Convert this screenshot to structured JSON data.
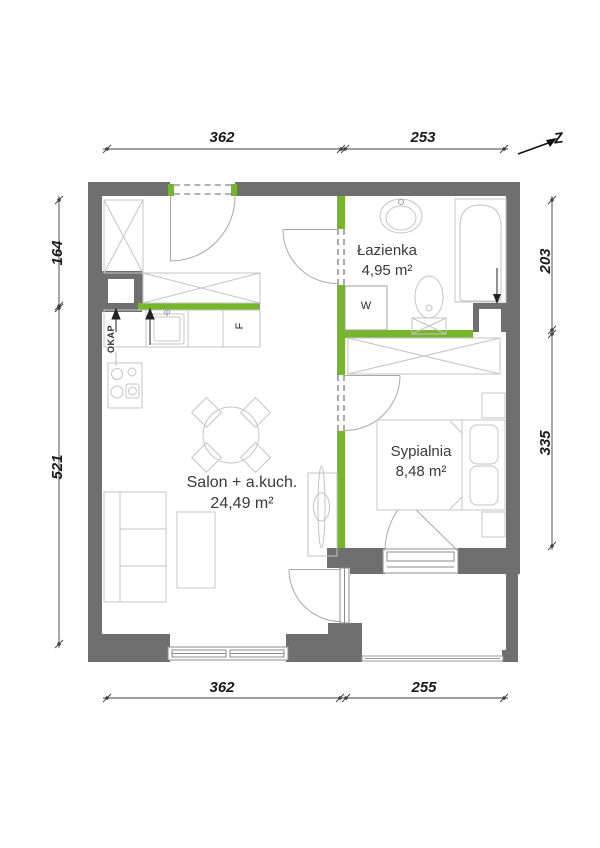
{
  "title": "apartment-floor-plan",
  "north_label": "Z",
  "rooms": [
    {
      "name": "Łazienka",
      "area": "4,95 m²"
    },
    {
      "name": "Sypialnia",
      "area": "8,48 m²"
    },
    {
      "name": "Salon + a.kuch.",
      "area": "24,49 m²"
    }
  ],
  "labels": {
    "hood": "OKAP",
    "washer": "W",
    "fridge": "F"
  },
  "dimensions": {
    "top": [
      "362",
      "253"
    ],
    "bottom": [
      "362",
      "255"
    ],
    "left": [
      "164",
      "521"
    ],
    "right": [
      "203",
      "335"
    ]
  },
  "colors": {
    "wall": "#6f6f6f",
    "accent_green": "#77b62c",
    "furniture_line": "#c4c4c4",
    "dim_line": "#3f3f3f"
  }
}
